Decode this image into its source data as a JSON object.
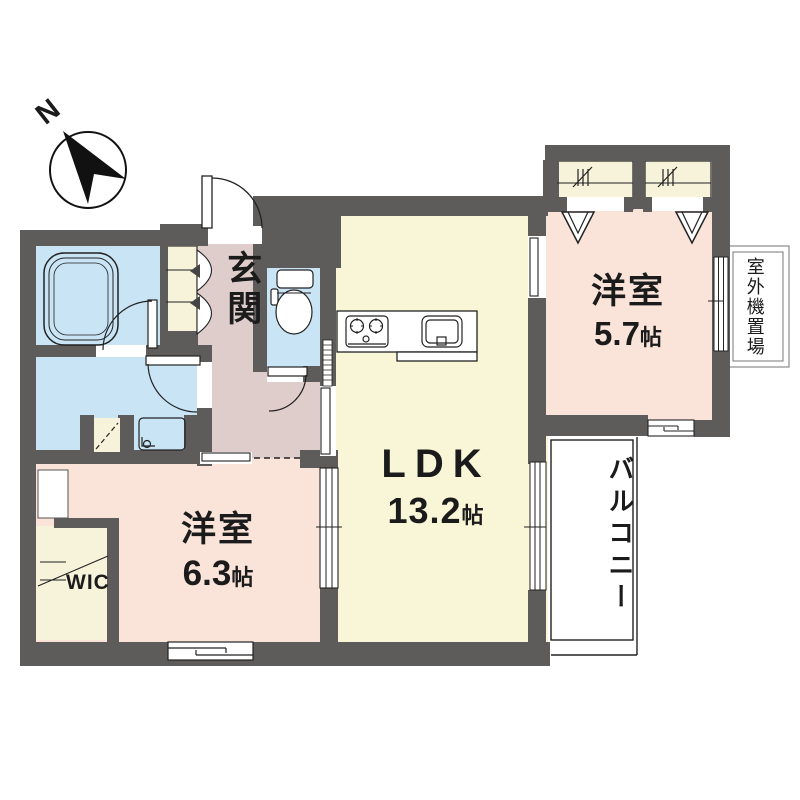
{
  "compass": {
    "label": "N"
  },
  "rooms": {
    "ldk": {
      "name": "LDK",
      "area_value": "13.2",
      "area_unit": "帖"
    },
    "bedroom1": {
      "name": "洋室",
      "area_value": "5.7",
      "area_unit": "帖"
    },
    "bedroom2": {
      "name": "洋室",
      "area_value": "6.3",
      "area_unit": "帖"
    },
    "entrance": {
      "name": "玄関"
    },
    "walk_in_closet": {
      "name": "WIC"
    },
    "balcony": {
      "name": "バルコニー"
    },
    "outdoor_unit_area": {
      "name": "室外機置場"
    }
  },
  "colors": {
    "wall": "#5E5B5B",
    "ldk_floor": "#F8F6D7",
    "bedroom_floor": "#FAE4DA",
    "entrance_floor": "#DFCDCC",
    "wet_area_floor": "#C9E4F5",
    "closet_floor": "#F7F3DA",
    "line": "#222222"
  }
}
